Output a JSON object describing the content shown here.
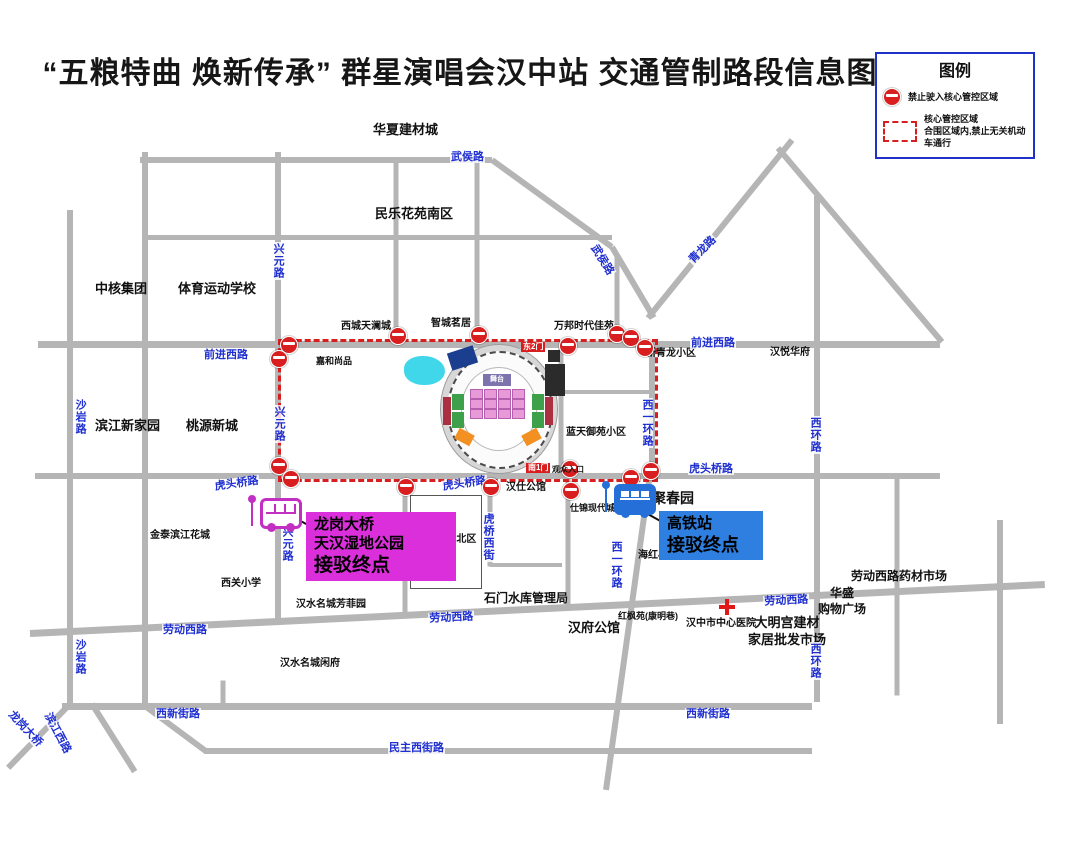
{
  "title": "“五粮特曲 焕新传承” 群星演唱会汉中站 交通管制路段信息图",
  "legend": {
    "title": "图例",
    "no_entry_icon": "no-entry-icon",
    "no_entry_label": "禁止驶入核心管控区域",
    "zone_icon": "control-zone-dashed-swatch",
    "zone_label_line1": "核心管控区域",
    "zone_label_line2": "合围区域内,禁止无关机动车通行"
  },
  "colors": {
    "road": "#b5b5b5",
    "road_label": "#1f2fd0",
    "restricted": "#d81e1e",
    "pond": "#41d7ea",
    "hospital_cross": "#e01818"
  },
  "stadium": {
    "gate_east": "东2门",
    "gate_south": "南1门",
    "south_note": "观众入口",
    "stage_label": "舞台",
    "pond": {
      "x": 404,
      "y": 356,
      "w": 41,
      "h": 29
    },
    "pink_grid": {
      "xs": [
        470,
        484,
        498,
        512
      ],
      "ys": [
        389,
        399,
        409
      ],
      "w": 11,
      "h": 8,
      "color": "#e89ad8"
    },
    "blocks": [
      [
        452,
        394,
        12,
        16,
        "#3fa04b",
        0
      ],
      [
        452,
        412,
        12,
        16,
        "#3fa04b",
        0
      ],
      [
        532,
        394,
        12,
        16,
        "#3fa04b",
        0
      ],
      [
        532,
        412,
        12,
        16,
        "#3fa04b",
        0
      ],
      [
        443,
        397,
        8,
        28,
        "#ab2f40",
        0
      ],
      [
        545,
        397,
        8,
        28,
        "#ab2f40",
        0
      ],
      [
        456,
        431,
        17,
        12,
        "#f29122",
        28
      ],
      [
        523,
        431,
        17,
        12,
        "#f29122",
        -28
      ],
      [
        449,
        349,
        27,
        18,
        "#1c3e8e",
        -18
      ],
      [
        545,
        364,
        20,
        32,
        "#2b2b2b",
        0
      ],
      [
        548,
        350,
        12,
        12,
        "#2b2b2b",
        0
      ]
    ]
  },
  "map": {
    "control_zone": {
      "x": 278,
      "y": 339,
      "w": 374,
      "h": 137
    },
    "roads": [
      [
        140,
        160,
        492,
        160,
        6
      ],
      [
        492,
        160,
        612,
        247,
        6
      ],
      [
        612,
        247,
        654,
        318,
        6
      ],
      [
        145,
        237,
        612,
        237,
        5
      ],
      [
        38,
        344,
        940,
        344,
        7
      ],
      [
        648,
        318,
        792,
        140,
        6
      ],
      [
        778,
        148,
        942,
        342,
        6
      ],
      [
        35,
        476,
        940,
        476,
        6
      ],
      [
        560,
        392,
        652,
        392,
        4
      ],
      [
        30,
        633,
        1045,
        584,
        7
      ],
      [
        62,
        706,
        812,
        706,
        7
      ],
      [
        205,
        751,
        812,
        751,
        6
      ],
      [
        70,
        210,
        70,
        706,
        6
      ],
      [
        145,
        152,
        145,
        706,
        6
      ],
      [
        278,
        152,
        278,
        624,
        6
      ],
      [
        396,
        162,
        396,
        344,
        5
      ],
      [
        477,
        162,
        477,
        344,
        5
      ],
      [
        617,
        255,
        617,
        344,
        5
      ],
      [
        652,
        341,
        652,
        474,
        6
      ],
      [
        650,
        474,
        606,
        790,
        6
      ],
      [
        405,
        478,
        405,
        616,
        5
      ],
      [
        490,
        478,
        490,
        566,
        5
      ],
      [
        490,
        565,
        562,
        565,
        4
      ],
      [
        568,
        466,
        568,
        610,
        5
      ],
      [
        561,
        346,
        561,
        474,
        5
      ],
      [
        817,
        196,
        817,
        702,
        6
      ],
      [
        897,
        476,
        897,
        695,
        5
      ],
      [
        1000,
        520,
        1000,
        724,
        6
      ],
      [
        68,
        706,
        8,
        768,
        6
      ],
      [
        92,
        704,
        135,
        772,
        6
      ],
      [
        145,
        706,
        207,
        752,
        6
      ],
      [
        223,
        680,
        223,
        708,
        5
      ]
    ],
    "no_entry_points": [
      [
        288,
        344
      ],
      [
        278,
        358
      ],
      [
        397,
        335
      ],
      [
        478,
        334
      ],
      [
        567,
        345
      ],
      [
        616,
        333
      ],
      [
        630,
        337
      ],
      [
        644,
        347
      ],
      [
        650,
        470
      ],
      [
        630,
        477
      ],
      [
        569,
        468
      ],
      [
        570,
        490
      ],
      [
        278,
        465
      ],
      [
        290,
        478
      ],
      [
        405,
        486
      ],
      [
        490,
        486
      ]
    ],
    "road_labels": [
      {
        "t": "武侯路",
        "x": 450,
        "y": 151
      },
      {
        "t": "武侯路",
        "x": 598,
        "y": 242,
        "rot": 58
      },
      {
        "t": "青龙路",
        "x": 686,
        "y": 258,
        "rot": -45
      },
      {
        "t": "兴元路",
        "x": 272,
        "y": 242,
        "v": true
      },
      {
        "t": "兴元路",
        "x": 273,
        "y": 405,
        "v": true
      },
      {
        "t": "兴元路",
        "x": 281,
        "y": 525,
        "v": true
      },
      {
        "t": "前进西路",
        "x": 203,
        "y": 349
      },
      {
        "t": "前进西路",
        "x": 690,
        "y": 337
      },
      {
        "t": "沙岩路",
        "x": 74,
        "y": 398,
        "v": true
      },
      {
        "t": "沙岩路",
        "x": 74,
        "y": 638,
        "v": true
      },
      {
        "t": "虎头桥路",
        "x": 213,
        "y": 481,
        "rot": -8
      },
      {
        "t": "虎头桥路",
        "x": 441,
        "y": 481,
        "rot": -8
      },
      {
        "t": "虎头桥路",
        "x": 688,
        "y": 463
      },
      {
        "t": "石门巷",
        "x": 398,
        "y": 520,
        "v": true
      },
      {
        "t": "虎桥西街",
        "x": 482,
        "y": 512,
        "v": true
      },
      {
        "t": "西一环路",
        "x": 641,
        "y": 398,
        "v": true
      },
      {
        "t": "西一环路",
        "x": 610,
        "y": 540,
        "v": true
      },
      {
        "t": "西环路",
        "x": 809,
        "y": 416,
        "v": true
      },
      {
        "t": "西环路",
        "x": 809,
        "y": 642,
        "v": true
      },
      {
        "t": "劳动西路",
        "x": 162,
        "y": 624
      },
      {
        "t": "劳动西路",
        "x": 428,
        "y": 613,
        "rot": -3
      },
      {
        "t": "劳动西路",
        "x": 763,
        "y": 596,
        "rot": -3
      },
      {
        "t": "西新街路",
        "x": 155,
        "y": 708
      },
      {
        "t": "西新街路",
        "x": 685,
        "y": 708
      },
      {
        "t": "民主西街路",
        "x": 388,
        "y": 742
      },
      {
        "t": "龙岗大桥",
        "x": 14,
        "y": 708,
        "rot": 47
      },
      {
        "t": "滨江西路",
        "x": 52,
        "y": 710,
        "rot": 62
      }
    ],
    "place_labels": [
      {
        "x": 373,
        "y": 122,
        "s": 13,
        "l": [
          "华夏建材城"
        ]
      },
      {
        "x": 375,
        "y": 206,
        "s": 13,
        "l": [
          "民乐花苑南区"
        ]
      },
      {
        "x": 95,
        "y": 281,
        "s": 13,
        "l": [
          "中核集团"
        ]
      },
      {
        "x": 178,
        "y": 281,
        "s": 13,
        "l": [
          "体育运动学校"
        ]
      },
      {
        "x": 341,
        "y": 320,
        "s": 10,
        "l": [
          "西城天澜城"
        ]
      },
      {
        "x": 431,
        "y": 317,
        "s": 10,
        "l": [
          "智城茗居"
        ]
      },
      {
        "x": 554,
        "y": 320,
        "s": 10,
        "l": [
          "万邦时代佳苑"
        ]
      },
      {
        "x": 646,
        "y": 347,
        "s": 10,
        "l": [
          "新青龙小区"
        ]
      },
      {
        "x": 770,
        "y": 346,
        "s": 10,
        "l": [
          "汉悦华府"
        ]
      },
      {
        "x": 316,
        "y": 356,
        "s": 9,
        "l": [
          "嘉和尚品"
        ]
      },
      {
        "x": 95,
        "y": 418,
        "s": 13,
        "l": [
          "滨江新家园"
        ]
      },
      {
        "x": 186,
        "y": 418,
        "s": 13,
        "l": [
          "桃源新城"
        ]
      },
      {
        "x": 566,
        "y": 426,
        "s": 10,
        "l": [
          "蓝天御苑小区"
        ]
      },
      {
        "x": 506,
        "y": 481,
        "s": 10,
        "l": [
          "汉仕公馆"
        ]
      },
      {
        "x": 570,
        "y": 503,
        "s": 9,
        "l": [
          "仕锦现代城"
        ]
      },
      {
        "x": 638,
        "y": 549,
        "s": 10,
        "l": [
          "海红小区"
        ]
      },
      {
        "x": 150,
        "y": 529,
        "s": 10,
        "l": [
          "金泰滨江花城"
        ]
      },
      {
        "x": 221,
        "y": 577,
        "s": 10,
        "l": [
          "西关小学"
        ]
      },
      {
        "x": 413,
        "y": 533,
        "s": 10,
        "l": [
          "汉水名城-北区"
        ]
      },
      {
        "x": 296,
        "y": 598,
        "s": 10,
        "l": [
          "汉水名城芳菲园"
        ]
      },
      {
        "x": 280,
        "y": 657,
        "s": 10,
        "l": [
          "汉水名城闲府"
        ]
      },
      {
        "x": 484,
        "y": 591,
        "s": 12,
        "l": [
          "石门水库管理局"
        ]
      },
      {
        "x": 568,
        "y": 620,
        "s": 13,
        "l": [
          "汉府公馆"
        ]
      },
      {
        "x": 618,
        "y": 611,
        "s": 9,
        "l": [
          "红枫苑(康明巷)"
        ]
      },
      {
        "x": 686,
        "y": 617,
        "s": 10,
        "l": [
          "汉中市中心医院"
        ]
      },
      {
        "x": 748,
        "y": 615,
        "s": 13,
        "l": [
          "大明宫建材",
          "家居批发市场"
        ]
      },
      {
        "x": 851,
        "y": 569,
        "s": 12,
        "l": [
          "劳动西路药材市场"
        ]
      },
      {
        "x": 818,
        "y": 586,
        "s": 12,
        "l": [
          "华盛",
          "购物广场"
        ]
      },
      {
        "x": 652,
        "y": 489,
        "s": 14,
        "l": [
          "聚春园"
        ]
      }
    ],
    "boxes": [
      {
        "x": 410,
        "y": 495,
        "w": 70,
        "h": 92
      }
    ],
    "hospital": {
      "x": 719,
      "y": 599
    }
  },
  "shuttles": [
    {
      "name": "longgang-shuttle",
      "color": "#db2fdb",
      "lines": [
        "龙岗大桥",
        "天汉湿地公园",
        "接驳终点"
      ],
      "sizes": [
        15,
        15,
        19
      ],
      "box": {
        "x": 306,
        "y": 512,
        "w": 150
      },
      "pointer": [
        297,
        519,
        319,
        531
      ]
    },
    {
      "name": "hsr-shuttle",
      "color": "#2e7fe0",
      "lines": [
        "高铁站",
        "接驳终点"
      ],
      "sizes": [
        15,
        18
      ],
      "box": {
        "x": 659,
        "y": 511,
        "w": 104
      },
      "pointer": [
        646,
        513,
        664,
        523
      ]
    }
  ]
}
